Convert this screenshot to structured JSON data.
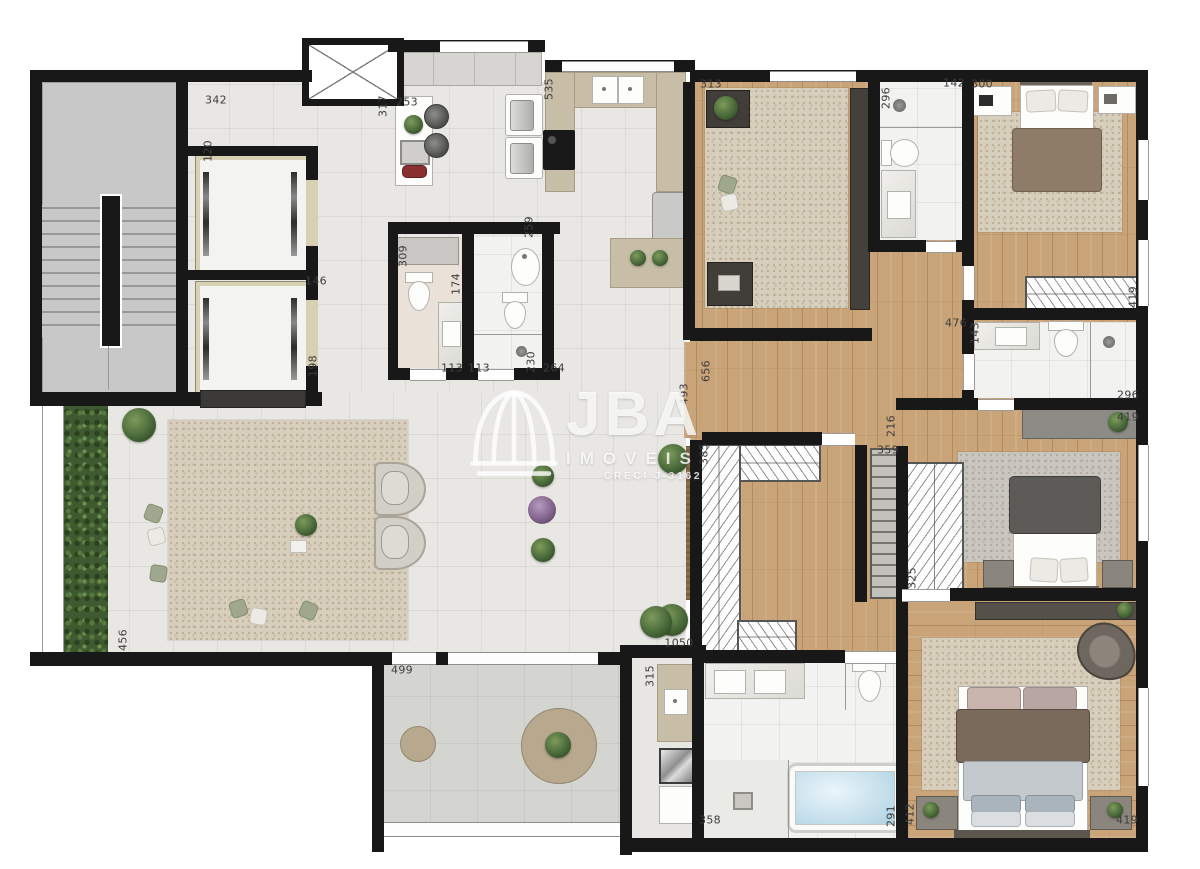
{
  "watermark": {
    "brand": "JBA",
    "line2": "IMÓVEIS",
    "line3": "CRECI J-3162"
  },
  "dimension_labels": [
    {
      "t": "342",
      "x": 216,
      "y": 100,
      "v": 0
    },
    {
      "t": "120",
      "x": 208,
      "y": 151,
      "v": 1
    },
    {
      "t": "317",
      "x": 383,
      "y": 106,
      "v": 1
    },
    {
      "t": "253",
      "x": 407,
      "y": 102,
      "v": 0
    },
    {
      "t": "535",
      "x": 549,
      "y": 89,
      "v": 1
    },
    {
      "t": "313",
      "x": 711,
      "y": 84,
      "v": 0
    },
    {
      "t": "296",
      "x": 886,
      "y": 98,
      "v": 1
    },
    {
      "t": "142",
      "x": 954,
      "y": 83,
      "v": 0
    },
    {
      "t": "300",
      "x": 982,
      "y": 84,
      "v": 0
    },
    {
      "t": "146",
      "x": 316,
      "y": 281,
      "v": 0
    },
    {
      "t": "198",
      "x": 313,
      "y": 366,
      "v": 1
    },
    {
      "t": "309",
      "x": 403,
      "y": 256,
      "v": 1
    },
    {
      "t": "174",
      "x": 456,
      "y": 284,
      "v": 1
    },
    {
      "t": "259",
      "x": 529,
      "y": 227,
      "v": 1
    },
    {
      "t": "230",
      "x": 531,
      "y": 362,
      "v": 1
    },
    {
      "t": "264",
      "x": 554,
      "y": 368,
      "v": 0
    },
    {
      "t": "113",
      "x": 452,
      "y": 368,
      "v": 0
    },
    {
      "t": "113",
      "x": 479,
      "y": 368,
      "v": 0
    },
    {
      "t": "493",
      "x": 684,
      "y": 394,
      "v": 1
    },
    {
      "t": "656",
      "x": 706,
      "y": 371,
      "v": 1
    },
    {
      "t": "385",
      "x": 704,
      "y": 454,
      "v": 1
    },
    {
      "t": "359",
      "x": 888,
      "y": 450,
      "v": 0
    },
    {
      "t": "216",
      "x": 891,
      "y": 426,
      "v": 1
    },
    {
      "t": "476",
      "x": 956,
      "y": 323,
      "v": 0
    },
    {
      "t": "143",
      "x": 975,
      "y": 333,
      "v": 1
    },
    {
      "t": "296",
      "x": 1128,
      "y": 395,
      "v": 0
    },
    {
      "t": "419",
      "x": 1128,
      "y": 417,
      "v": 0
    },
    {
      "t": "419",
      "x": 1133,
      "y": 297,
      "v": 1
    },
    {
      "t": "325",
      "x": 912,
      "y": 578,
      "v": 1
    },
    {
      "t": "456",
      "x": 123,
      "y": 640,
      "v": 1
    },
    {
      "t": "499",
      "x": 402,
      "y": 670,
      "v": 0
    },
    {
      "t": "1050",
      "x": 679,
      "y": 643,
      "v": 0
    },
    {
      "t": "315",
      "x": 650,
      "y": 676,
      "v": 1
    },
    {
      "t": "358",
      "x": 710,
      "y": 820,
      "v": 0
    },
    {
      "t": "291",
      "x": 891,
      "y": 816,
      "v": 1
    },
    {
      "t": "412",
      "x": 910,
      "y": 814,
      "v": 1
    },
    {
      "t": "419",
      "x": 1127,
      "y": 820,
      "v": 0
    }
  ],
  "colors": {
    "wall": "#181818",
    "wood_floor": "#c9a478",
    "tile_floor": "#e9e7e3",
    "bath_floor": "#f2f2f0",
    "terrace_floor": "#d4d4d1",
    "rug_beige": "#d8cebc",
    "rug_gray": "#c9c6c0",
    "counter": "#c8bda6",
    "sofa": "#b0aeaa",
    "wood_furniture": "#96764f",
    "hedge": "#3f5a31",
    "plant": "#49693a",
    "tub_water": "#bedbe9",
    "watermark_color": "rgba(255,255,255,0.80)"
  }
}
